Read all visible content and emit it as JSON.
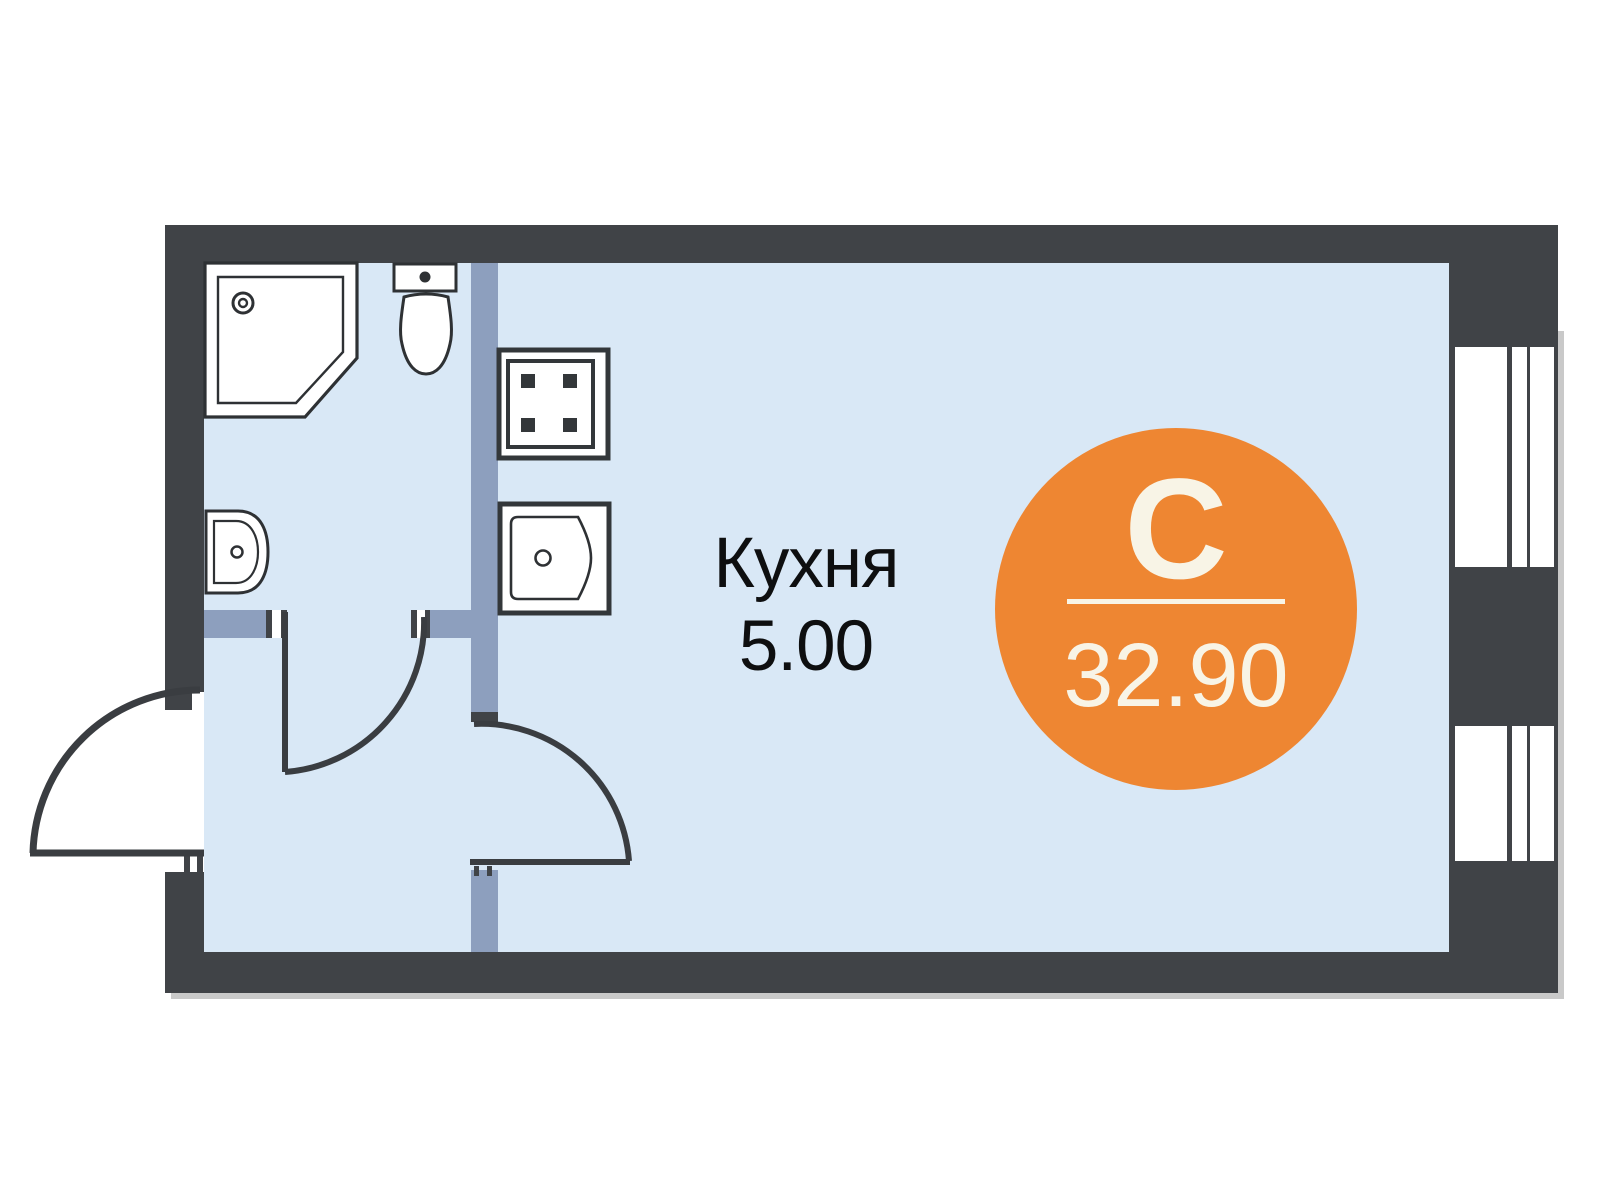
{
  "plan": {
    "room_label": {
      "name": "Кухня",
      "area": "5.00"
    },
    "badge": {
      "letter": "С",
      "area": "32.90"
    },
    "colors": {
      "wall": "#404347",
      "partition": "#8d9fbe",
      "floor": "#d9e8f6",
      "fixture_outline": "#2e3134",
      "door_line": "#3a3d41",
      "accent_orange": "#ee8632",
      "badge_text": "#f8f4e6",
      "label_text": "#0e0f10",
      "shadow": "#c9c9c9"
    },
    "fixtures": [
      "shower",
      "toilet",
      "wash-basin",
      "stove",
      "kitchen-sink"
    ],
    "windows_count": 2,
    "doors_count": 3
  }
}
